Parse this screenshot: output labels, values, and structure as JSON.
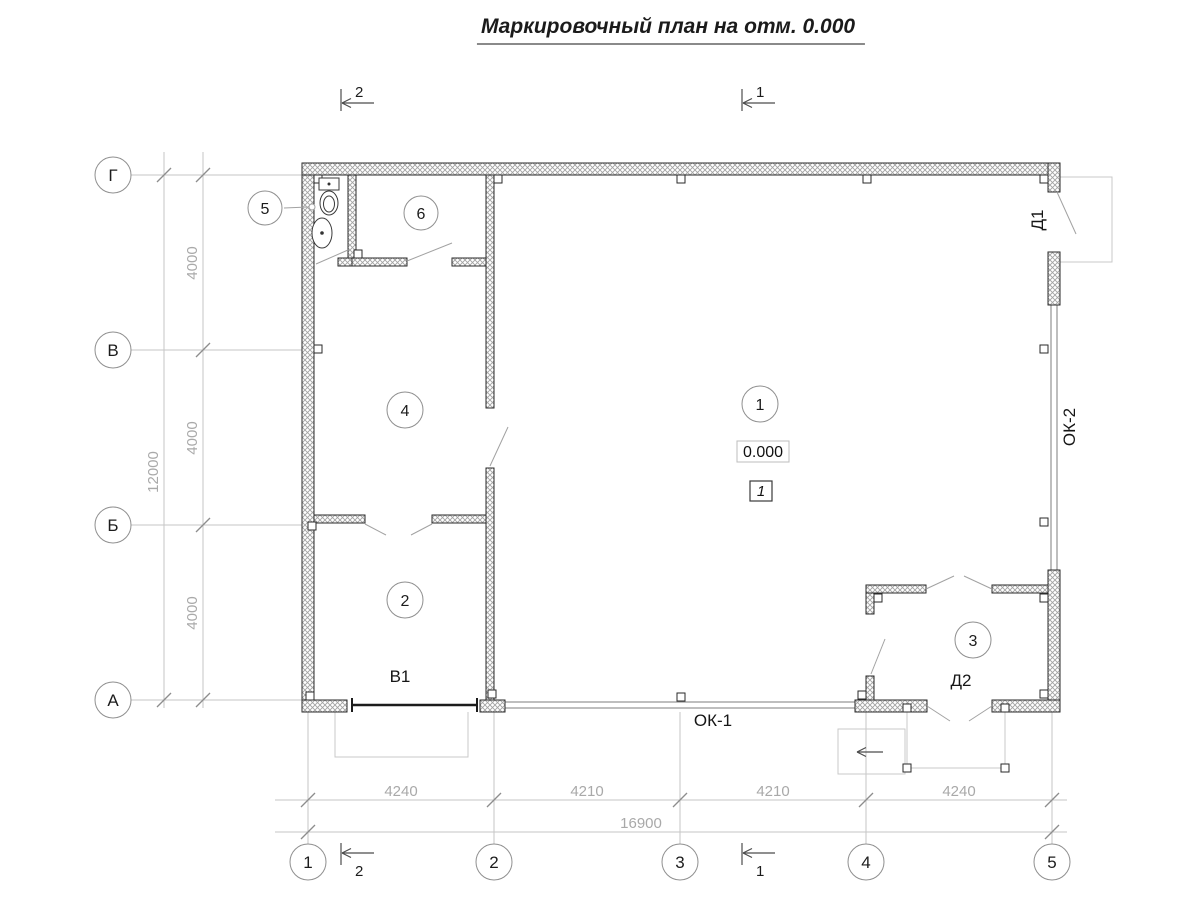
{
  "title": "Маркировочный план на отм. 0.000",
  "grid_rows": [
    "Г",
    "В",
    "Б",
    "А"
  ],
  "grid_cols": [
    "1",
    "2",
    "3",
    "4",
    "5"
  ],
  "dim_left": [
    "4000",
    "4000",
    "4000"
  ],
  "dim_left_total": "12000",
  "dim_bottom": [
    "4240",
    "4210",
    "4210",
    "4240"
  ],
  "dim_bottom_total": "16900",
  "rooms": [
    "1",
    "2",
    "3",
    "4",
    "5",
    "6"
  ],
  "labels": {
    "gate_b1": "В1",
    "door_d1": "Д1",
    "door_d2": "Д2",
    "window_ok1": "ОК-1",
    "window_ok2": "ОК-2",
    "elevation_mark": "0.000",
    "floor_type_mark": "1"
  },
  "sections": {
    "top_left": "2",
    "top_right": "1",
    "bottom_left": "2",
    "bottom_right": "1"
  },
  "colors": {
    "wall_outline": "#2a2a2a",
    "thin_lines": "#c6c6c6",
    "dim_text": "#a9a9a9",
    "main_text": "#1c1c1c"
  }
}
